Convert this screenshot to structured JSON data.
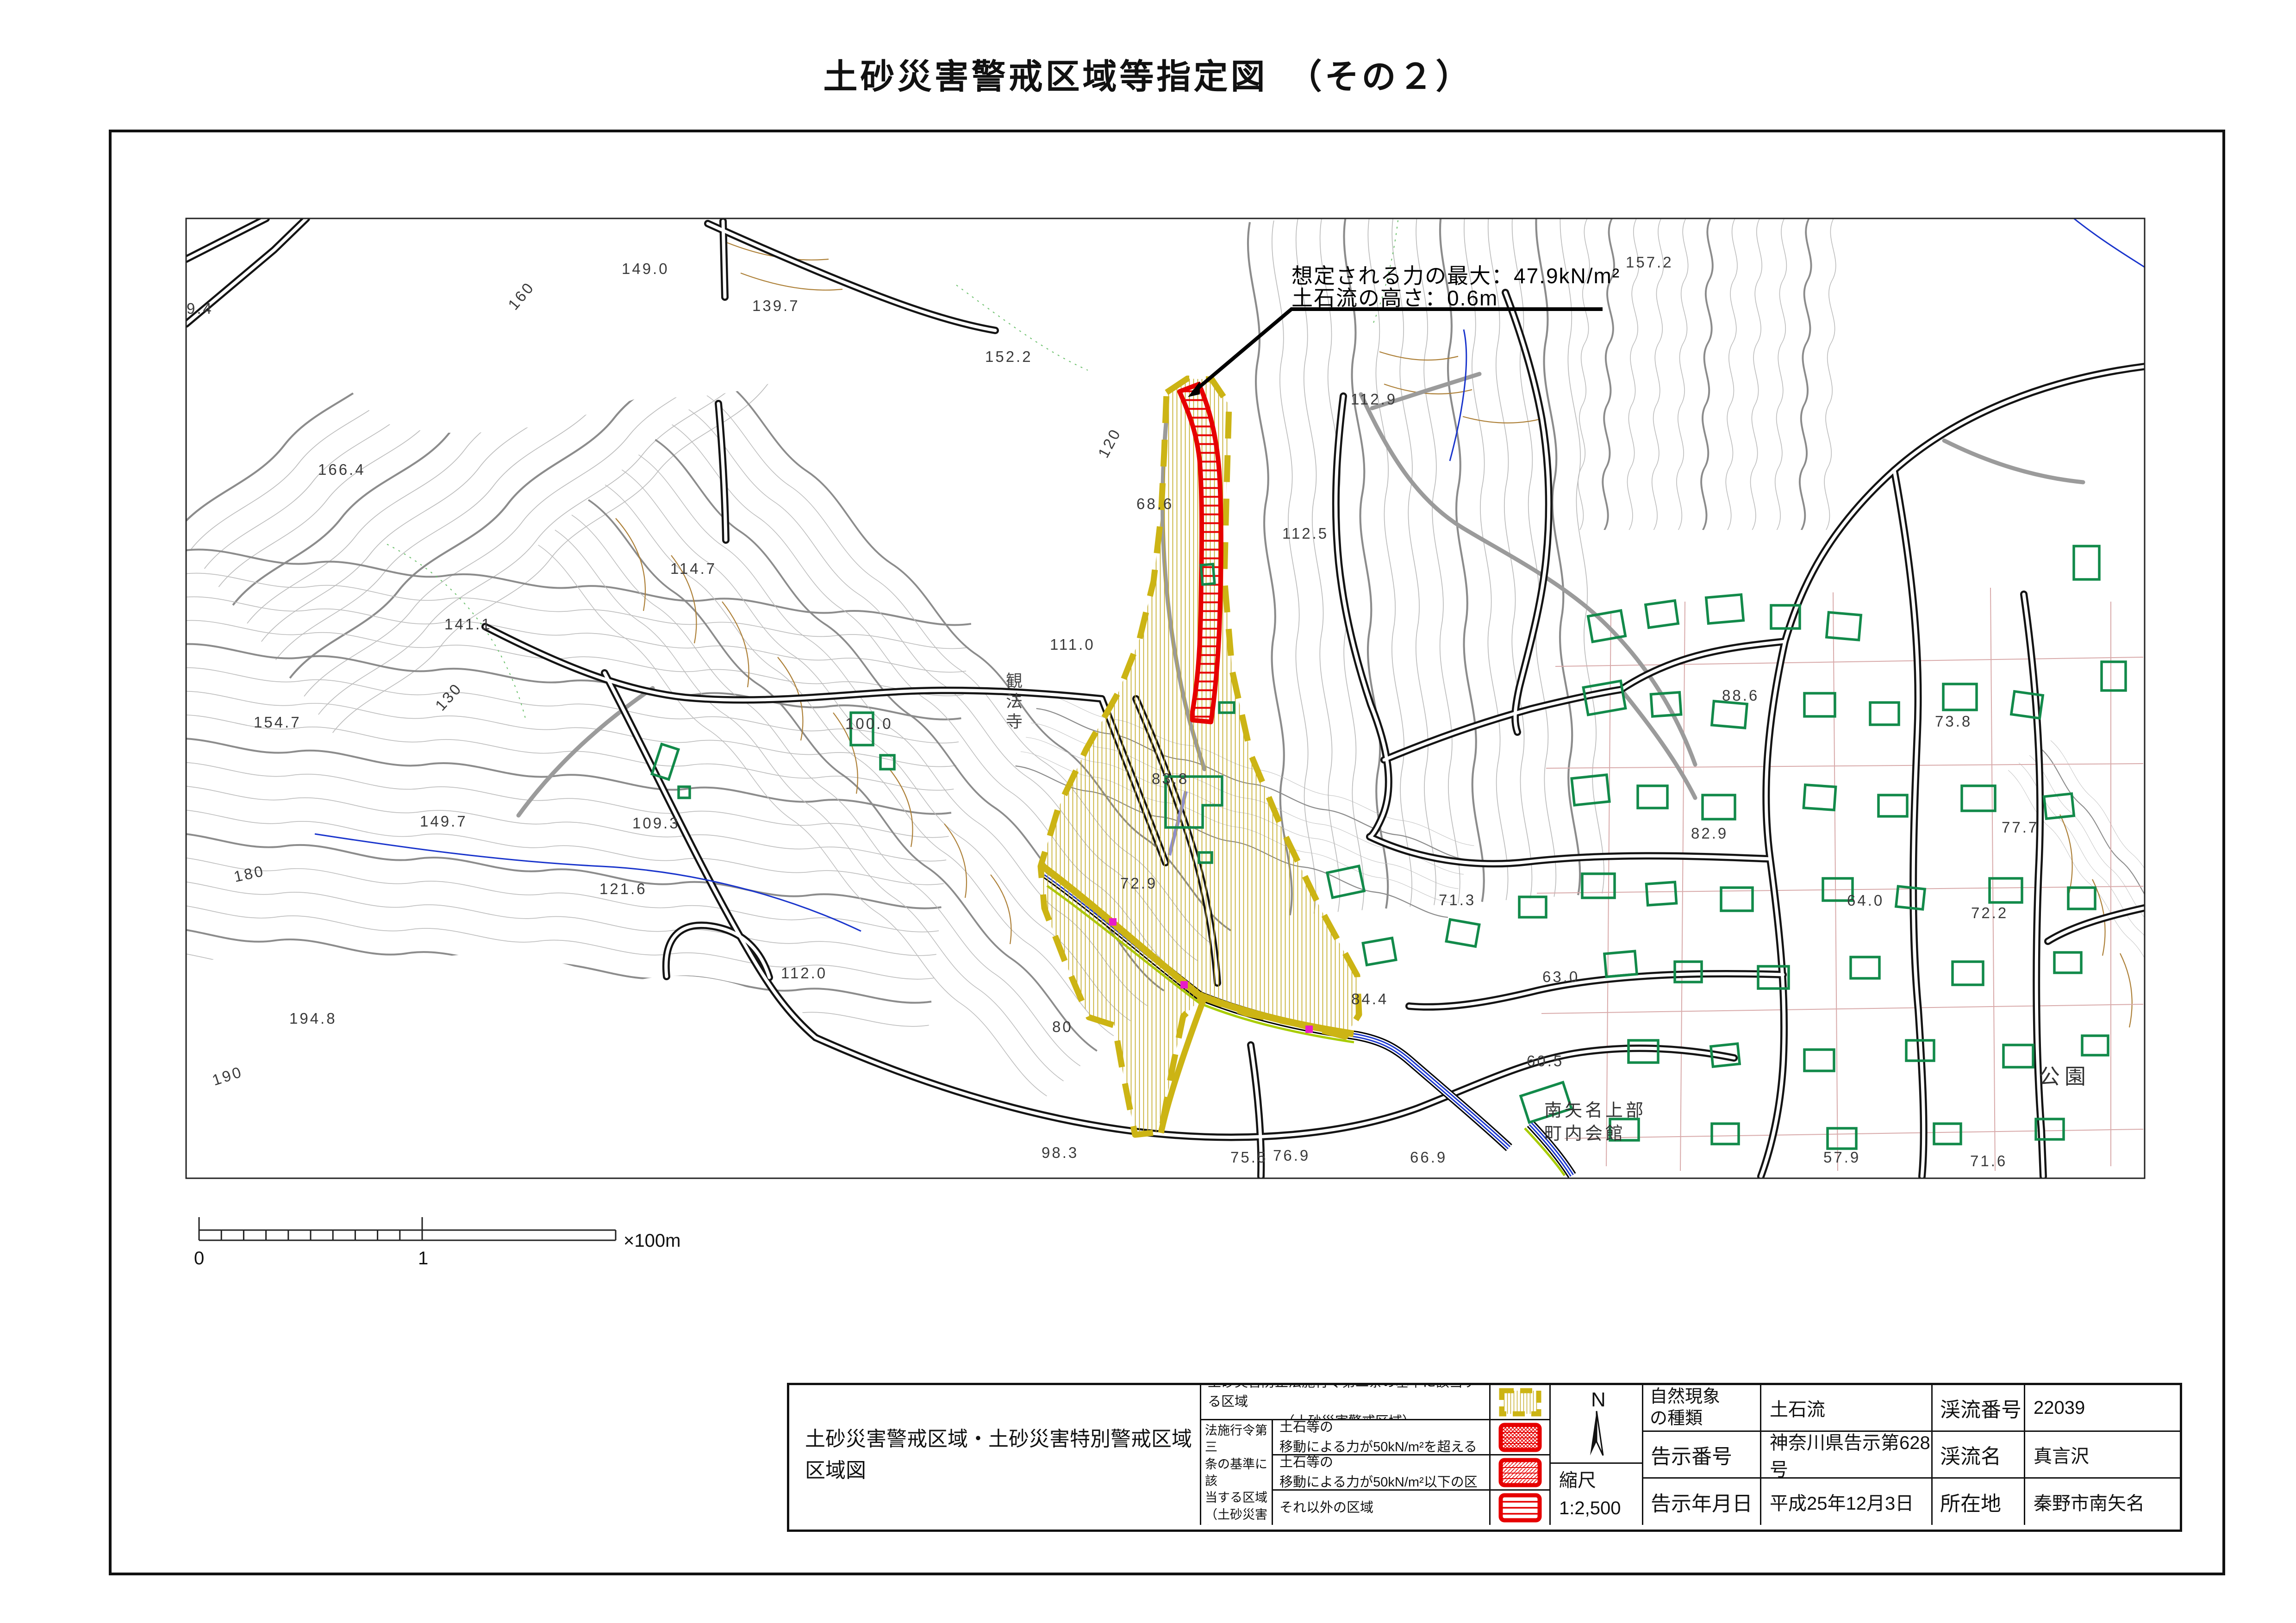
{
  "title": "土砂災害警戒区域等指定図　（その２）",
  "annotation": {
    "line1": "想定される力の最大：47.9kN/m²",
    "line2": "土石流の高さ：0.6m"
  },
  "scalebar": {
    "zero": "0",
    "one": "1",
    "unit": "×100m"
  },
  "legend": {
    "map_title_line1": "土砂災害警戒区域・土砂災害特別警戒区域",
    "map_title_line2": "区域図",
    "row1_line1": "土砂災害防止法施行令第二条の基準に該当する区域",
    "row1_line2": "（土砂災害警戒区域）",
    "group_label": "土砂災害防止\n法施行令第三\n条の基準に該\n当する区域\n（土砂災害特別\n警戒区域）",
    "row2_line1": "土石流の高さが１ｍ超える場合、土石等の",
    "row2_line2": "移動による力が50kN/m²を超える区域",
    "row3_line1": "土石流の高さが１ｍ超える場合、土石等の",
    "row3_line2": "移動による力が50kN/m²以下の区域",
    "row4": "それ以外の区域",
    "north": "N",
    "scale_label": "縮尺",
    "scale_value": "1:2,500"
  },
  "info": {
    "r1c1": "自然現象\nの種類",
    "r1c2": "土石流",
    "r1c3": "渓流番号",
    "r1c4": "22039",
    "r2c1": "告示番号",
    "r2c2": "神奈川県告示第628号",
    "r2c3": "渓流名",
    "r2c4": "真言沢",
    "r3c1": "告示年月日",
    "r3c2": "平成25年12月3日",
    "r3c3": "所在地",
    "r3c4": "秦野市南矢名"
  },
  "map": {
    "labels": [
      {
        "t": "157.2"
      },
      {
        "t": "149.0"
      },
      {
        "t": "139.7"
      },
      {
        "t": "9.4"
      },
      {
        "t": "166.4"
      },
      {
        "t": "152.2"
      },
      {
        "t": "114.7"
      },
      {
        "t": "141.1"
      },
      {
        "t": "111.0"
      },
      {
        "t": "112.9"
      },
      {
        "t": "112.5"
      },
      {
        "t": "68.6"
      },
      {
        "t": "120"
      },
      {
        "t": "160"
      },
      {
        "t": "130"
      },
      {
        "t": "180"
      },
      {
        "t": "190"
      },
      {
        "t": "154.7"
      },
      {
        "t": "149.7"
      },
      {
        "t": "194.8"
      },
      {
        "t": "121.6"
      },
      {
        "t": "112.0"
      },
      {
        "t": "109.3"
      },
      {
        "t": "100.0"
      },
      {
        "t": "83.8"
      },
      {
        "t": "80"
      },
      {
        "t": "98.3"
      },
      {
        "t": "75.5"
      },
      {
        "t": "66.9"
      },
      {
        "t": "76.9"
      },
      {
        "t": "84.4"
      },
      {
        "t": "63.0"
      },
      {
        "t": "71.3"
      },
      {
        "t": "60.5"
      },
      {
        "t": "88.6"
      },
      {
        "t": "82.9"
      },
      {
        "t": "73.8"
      },
      {
        "t": "77.7"
      },
      {
        "t": "72.2"
      },
      {
        "t": "64.0"
      },
      {
        "t": "57.9"
      },
      {
        "t": "71.6"
      },
      {
        "t": "72.9"
      },
      {
        "t": "公園"
      },
      {
        "t": "南矢名上部"
      },
      {
        "t": "町内会館"
      }
    ],
    "place_labels": {
      "temple": "観法寺"
    }
  },
  "colors": {
    "warning_area_yellow": "#ccb414",
    "special_area_red": "#e60000",
    "building_green": "#128a4a",
    "stream_blue": "#1a35cc",
    "contour_gray": "#bcbcbc",
    "index_contour_gray": "#8c8c8c",
    "road_black": "#141414",
    "parcel_pink": "#d8aaaa",
    "cliff_brown": "#ad8038",
    "accent_chartreuse": "#a8cc00",
    "marker_magenta": "#e81cc8"
  }
}
